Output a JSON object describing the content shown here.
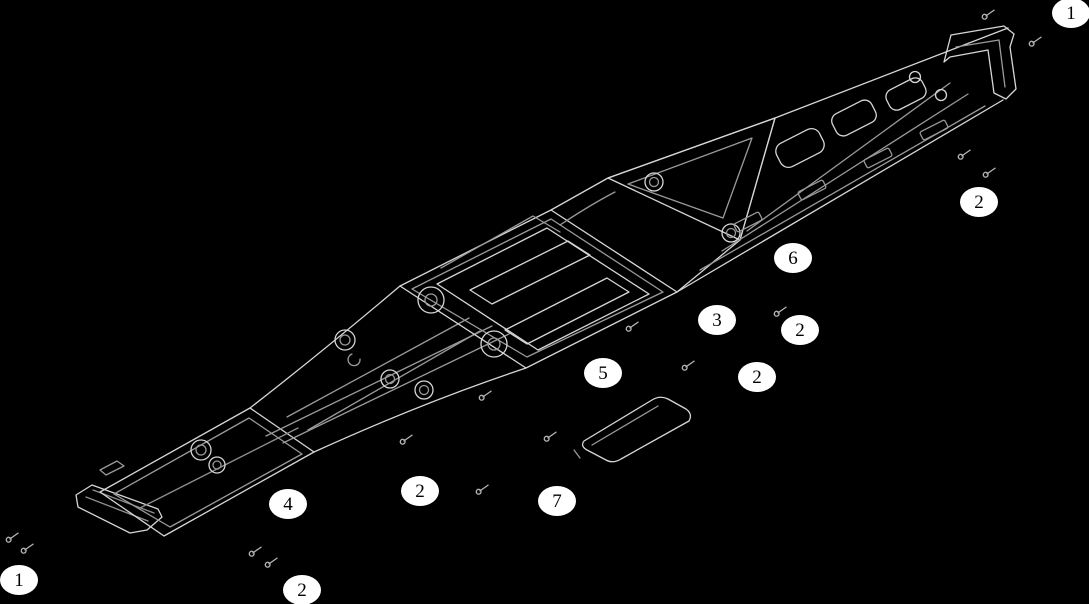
{
  "diagram": {
    "type": "exploded-parts-line-drawing",
    "subject": "vehicle chassis assembly",
    "background_color": "#000000",
    "line_color": "#d6d6d6",
    "secondary_line_color": "#9a9a9a",
    "callout_fill": "#ffffff",
    "callout_text_color": "#000000"
  },
  "callouts": [
    {
      "label": "1",
      "x": 1071,
      "y": 13
    },
    {
      "label": "2",
      "x": 979,
      "y": 202
    },
    {
      "label": "6",
      "x": 793,
      "y": 258
    },
    {
      "label": "3",
      "x": 717,
      "y": 320
    },
    {
      "label": "2",
      "x": 800,
      "y": 330
    },
    {
      "label": "2",
      "x": 757,
      "y": 377
    },
    {
      "label": "5",
      "x": 603,
      "y": 373
    },
    {
      "label": "2",
      "x": 420,
      "y": 491
    },
    {
      "label": "7",
      "x": 557,
      "y": 501
    },
    {
      "label": "4",
      "x": 288,
      "y": 504
    },
    {
      "label": "1",
      "x": 19,
      "y": 580
    },
    {
      "label": "2",
      "x": 302,
      "y": 590
    }
  ]
}
